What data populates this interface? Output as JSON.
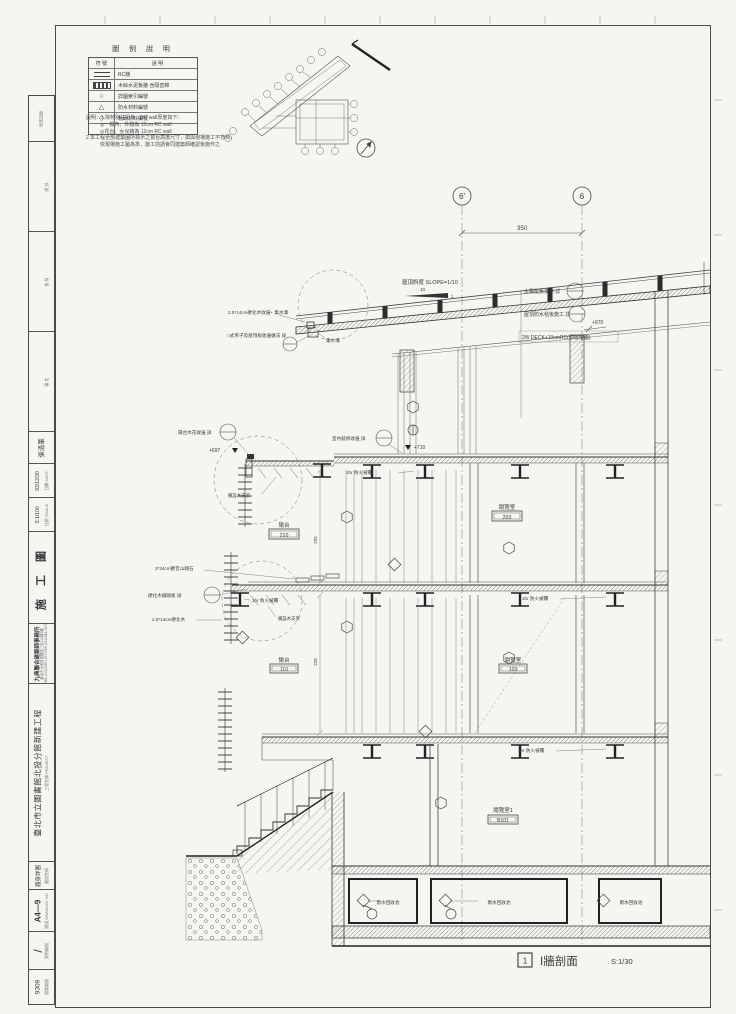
{
  "colors": {
    "ink": "#3a3a3a",
    "paper": "#f5f5f2",
    "accent": "#222222"
  },
  "legend": {
    "title": "圖 例 說 明",
    "col_symbol": "符 號",
    "col_desc": "說  明",
    "rows": [
      {
        "icon": "rc-line",
        "desc": "RC牆"
      },
      {
        "icon": "hatch-bar",
        "desc": "木絲水泥板牆 含隔音棉"
      },
      {
        "icon": "circle",
        "desc": "詳圖索引編號"
      },
      {
        "icon": "triangle",
        "desc": "防水材料編號"
      },
      {
        "icon": "diamond",
        "desc": "粉刷材料編號"
      }
    ]
  },
  "notes": {
    "lines": [
      "說明：1.除特別註記外，RC wall厚度如下：",
      "◎一般內、外牆為 15cm RC wall",
      "◎花台、女兒牆為 12cm RC wall",
      "2.本工程全部建築圖所標示之窗台高度尺寸，如與現場施工不符時，",
      "依現場施工圖為準，施工前請會同建築師確認後施作之"
    ]
  },
  "titleblock": {
    "revision": "修改記錄",
    "design": "設 計",
    "check": "查 核",
    "approve": "審 定",
    "designer": "張清華",
    "date_label": "日期 DATE",
    "date": "93/12/30",
    "scale_label": "比例 SCALE",
    "scale": "S:1/100",
    "phase": "施 工 圖",
    "firm": "九典聯合建築師事務所",
    "firm_addr": "臺北市大安區基隆路二段112號2樓",
    "firm_tel": "TEL:(02)2345-1377  FAX:(02)2345-1379",
    "project_label": "工程名稱 PROJECT",
    "project": "臺北市立圖書館北投分館新建工程",
    "drawing_label": "圖說名稱",
    "drawing_title": "牆身詳圖",
    "sheetno_label": "圖號 DRAWING NO",
    "sheet_no": "A4—9",
    "contract_label": "契約編號",
    "contract_no": "/",
    "file_label": "檔案編號",
    "file_no": "9309"
  },
  "drawing": {
    "grid_a": "6'",
    "grid_b": "6",
    "dim_grid": "350",
    "slope_note": "屋頂斜度 SLOPE=1/10",
    "slope_run": "10",
    "slope_rise": "1",
    "note_solar": "太陽能板支架 詳",
    "note_felt": "屋頂防水毯後施工 詳",
    "note_deck": "2W DECK+10cmRC(斜坡樓面)",
    "elev_roof": "+970",
    "note_edge": "2.5*14cm硬化木收邊+ 集水溝",
    "note_hanger": "□式吊子及屋頂板收邊做法 詳",
    "note_gutter": "集水溝",
    "note_balcony": "陽台木花收邊 詳",
    "elev_balcony": "+697",
    "note_interior": "室內裝修收邊 詳",
    "elev_2f": "+710",
    "note_fire": "1hr 防火被覆",
    "note_wood_support": "橫設木支架",
    "note_stone": "3*24cm觀音山踏石",
    "note_plate": "硬化木鋪踏板 詳",
    "note_hardwood": "2.5*14cm硬化木",
    "dim_v1": "225",
    "dim_v2": "225",
    "rooms": {
      "balcony2": {
        "name": "陽台",
        "no": "210"
      },
      "reading2": {
        "name": "閱覽室",
        "no": "203"
      },
      "balcony1": {
        "name": "陽台",
        "no": "110"
      },
      "reading1": {
        "name": "閱覽室",
        "no": "103"
      },
      "readingB": {
        "name": "閱覽室1",
        "no": "B101"
      }
    },
    "tank_label": "雨水回收池",
    "caption": {
      "no": "1",
      "title": "I牆剖面",
      "scale": "S:1/30"
    }
  }
}
